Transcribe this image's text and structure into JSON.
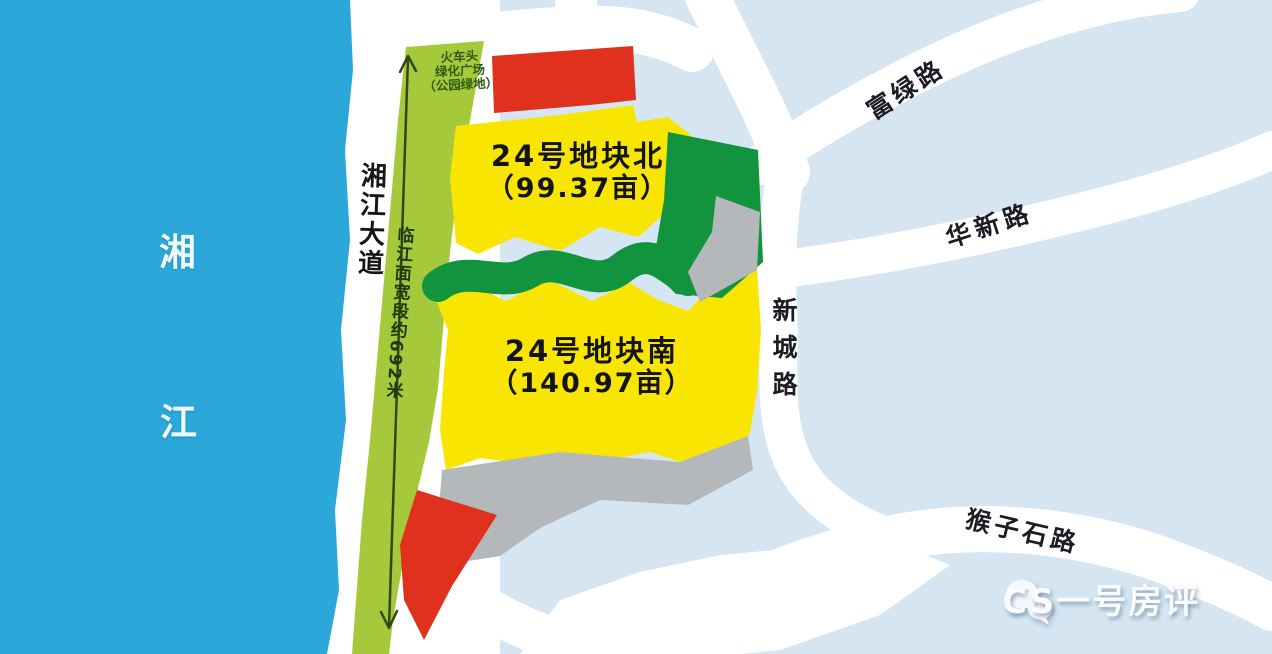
{
  "river": {
    "char_top": "湘",
    "char_bottom": "江"
  },
  "roads": {
    "xiangjiang_avenue": "湘江大道",
    "fulu": "富绿路",
    "huaxin": "华新路",
    "xincheng": "新城路",
    "houzishi": "猴子石路"
  },
  "parcels": {
    "north_name": "24号地块北",
    "north_area": "（99.37亩）",
    "south_name": "24号地块南",
    "south_area": "（140.97亩）"
  },
  "annotations": {
    "riverfront": "临江面宽段约692米",
    "landmark_line1": "火车头",
    "landmark_line2": "绿化广场",
    "landmark_line3": "（公园绿地）"
  },
  "watermark": {
    "label": "CS一号房评",
    "icon": "wechat-bubbles-icon"
  },
  "colors": {
    "background": "#d5e6f2",
    "road": "#ffffff",
    "river": "#2ba7d9",
    "greenbelt_strip": "#a6c93c",
    "park_green": "#12943f",
    "parcel_yellow": "#f8e602",
    "red_zone": "#e0301e",
    "gray_zone": "#b5b8ba",
    "arrow": "#2e4a12"
  }
}
